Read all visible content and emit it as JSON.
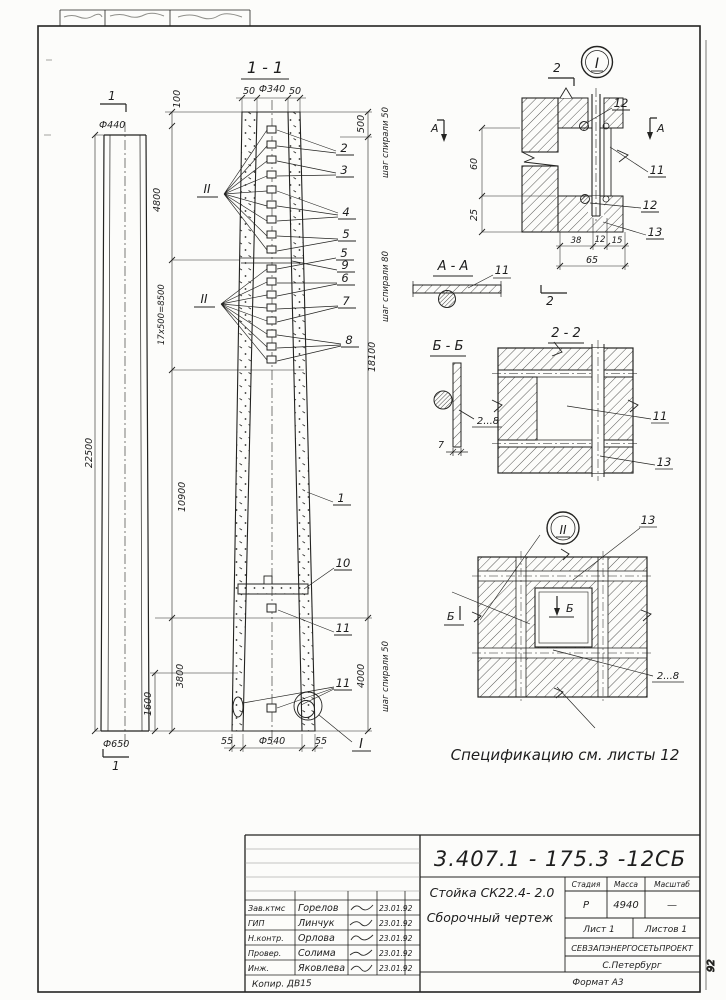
{
  "page": {
    "side_label": "92"
  },
  "views": {
    "left_view": {
      "mark_top": "1",
      "mark_bottom": "1",
      "dia_top": "Ф440",
      "dia_bottom": "Ф650",
      "length": "22500"
    },
    "main_section": {
      "label": "1 - 1",
      "detail_ref": "I",
      "rebar_flag": "II",
      "dims": {
        "top_left": "50",
        "top_dia": "Ф340",
        "top_right": "50",
        "seg_100": "100",
        "seg_4800": "4800",
        "seg_8500": "17х500=8500",
        "seg_10900": "10900",
        "seg_3800": "3800",
        "seg_1600": "1600",
        "right_500": "500",
        "right_18100": "18100",
        "right_4000": "4000",
        "spiral_top": "шаг спирали 50",
        "spiral_mid": "шаг спирали 80",
        "spiral_bottom": "шаг спирали 50",
        "bottom_left": "55",
        "bottom_dia": "Ф540",
        "bottom_right": "55"
      },
      "callouts": {
        "c1": "1",
        "c2": "2",
        "c3": "3",
        "c4": "4",
        "c5": "5",
        "c5b": "5",
        "c9": "9",
        "c6": "6",
        "c7": "7",
        "c8": "8",
        "c10": "10",
        "c11a": "11",
        "c11b": "11"
      }
    },
    "detail_top": {
      "title": "I",
      "section_mark_top": "2",
      "section_mark_bottom": "2",
      "marker_left": "А",
      "marker_right": "А",
      "callouts": {
        "c12a": "12",
        "c11": "11",
        "c12b": "12",
        "c13": "13"
      },
      "dims": {
        "v60": "60",
        "v25": "25",
        "h38": "38",
        "h12": "12",
        "h15": "15",
        "h65": "65"
      }
    },
    "section_aa": {
      "label": "А - А",
      "callout_11": "11"
    },
    "section_bb": {
      "label": "Б - Б",
      "callout_range": "2...8",
      "dim_7": "7"
    },
    "section_22": {
      "label": "2 - 2",
      "callout_11": "11",
      "callout_13": "13"
    },
    "detail_bottom": {
      "title": "II",
      "marker_left": "Б",
      "marker_inner": "Б",
      "callout_13": "13",
      "callout_range": "2...8"
    }
  },
  "notes": {
    "specification": "Спецификацию  см.  листы  12",
    "handwritten": "Копир. ДВ15"
  },
  "titleblock": {
    "doc_number": "3.407.1 - 175.3 -12СБ",
    "product": "Стойка СК22.4- 2.0",
    "doc_type": "Сборочный  чертеж",
    "stage_label": "Стадия",
    "mass_label": "Масса",
    "scale_label": "Масштаб",
    "stage": "Р",
    "mass": "4940",
    "scale": "—",
    "sheet": "Лист 1",
    "sheets": "Листов 1",
    "organization": "СЕВЗАПЭНЕРГОСЕТЬПРОЕКТ",
    "city": "С.Петербург",
    "format": "Формат А3",
    "signatures": [
      {
        "role": "Зав.ктмс",
        "name": "Горелов",
        "date": "23.01.92"
      },
      {
        "role": "ГИП",
        "name": "Линчук",
        "date": "23.01.92"
      },
      {
        "role": "Н.контр.",
        "name": "Орлова",
        "date": "23.01.92"
      },
      {
        "role": "Провер.",
        "name": "Солима",
        "date": "23.01.92"
      },
      {
        "role": "Инж.",
        "name": "Яковлева",
        "date": "23.01.92"
      }
    ]
  }
}
